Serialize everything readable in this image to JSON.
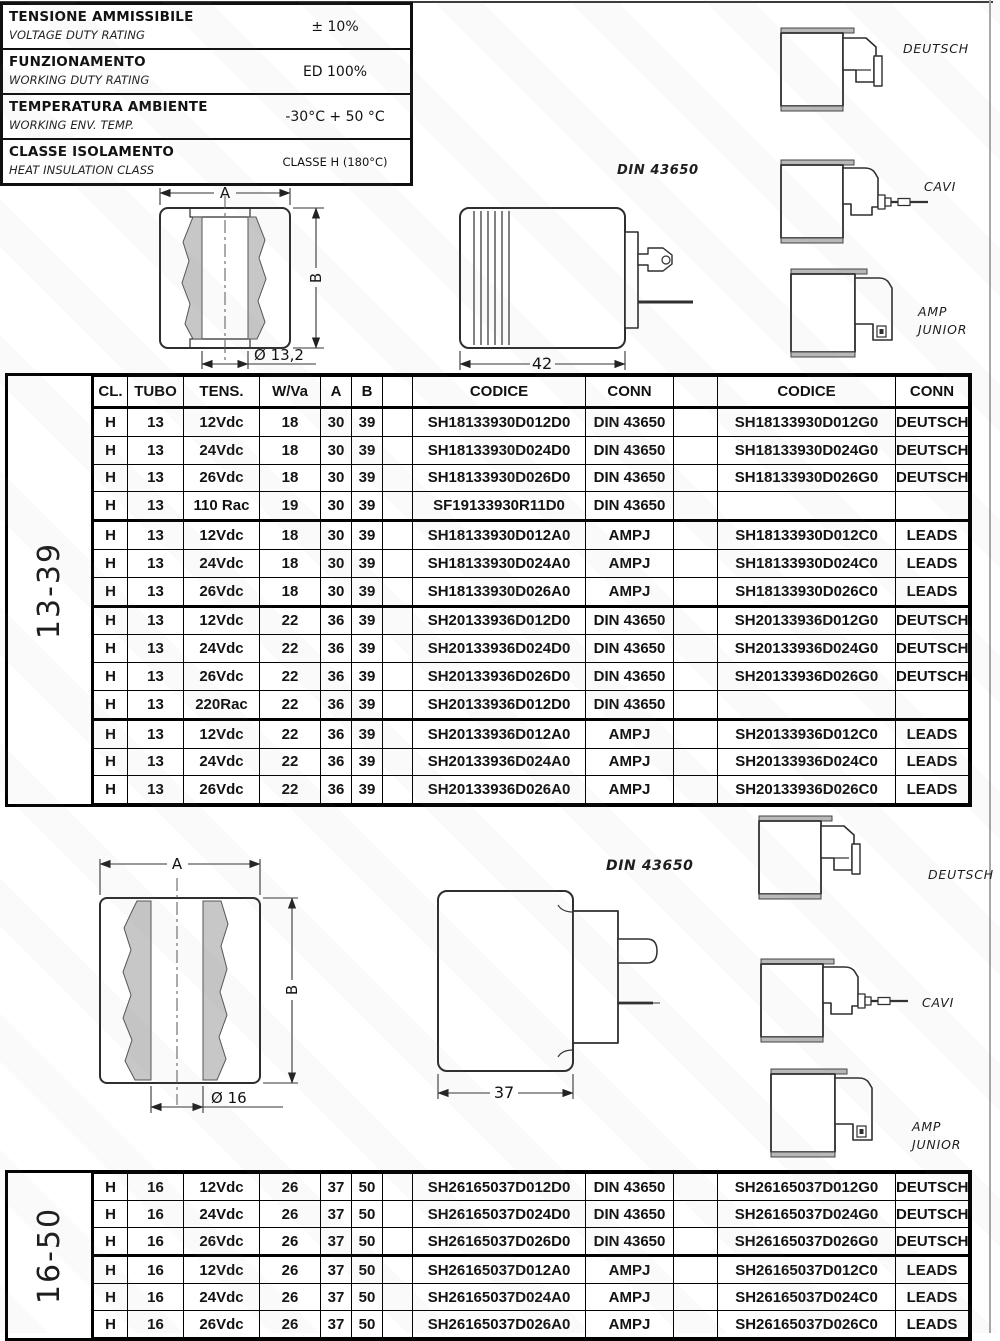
{
  "specs": {
    "rows": [
      {
        "it": "TENSIONE AMMISSIBILE",
        "en": "VOLTAGE DUTY RATING",
        "value": "± 10%"
      },
      {
        "it": "FUNZIONAMENTO",
        "en": "WORKING DUTY RATING",
        "value": "ED 100%"
      },
      {
        "it": "TEMPERATURA AMBIENTE",
        "en": "WORKING ENV. TEMP.",
        "value": "-30°C  + 50 °C"
      },
      {
        "it": "CLASSE ISOLAMENTO",
        "en": "HEAT INSULATION CLASS",
        "value": "CLASSE H (180°C)",
        "cls": "small"
      }
    ]
  },
  "drawings": {
    "s1": {
      "dim_a": "A",
      "dim_b": "B",
      "dim_dia": "Ø 13,2",
      "din_label": "DIN 43650",
      "din_dim": "42",
      "conn_deutsch": "DEUTSCH",
      "conn_cavi": "CAVI",
      "conn_amp": "AMP\nJUNIOR"
    },
    "s2": {
      "dim_a": "A",
      "dim_b": "B",
      "dim_dia": "Ø 16",
      "din_label": "DIN 43650",
      "din_dim": "37",
      "conn_deutsch": "DEUTSCH",
      "conn_cavi": "CAVI",
      "conn_amp": "AMP\nJUNIOR"
    }
  },
  "tables": {
    "t1": {
      "group": "13-39",
      "headers": [
        "CL.",
        "TUBO",
        "TENS.",
        "W/Va",
        "A",
        "B",
        "",
        "CODICE",
        "CONN",
        "",
        "CODICE",
        "CONN"
      ],
      "rows": [
        {
          "cl": "H",
          "tubo": "13",
          "tens": "12Vdc",
          "w": "18",
          "a": "30",
          "b": "39",
          "c1": "SH18133930D012D0",
          "n1": "DIN 43650",
          "c2": "SH18133930D012G0",
          "n2": "DEUTSCH"
        },
        {
          "cl": "H",
          "tubo": "13",
          "tens": "24Vdc",
          "w": "18",
          "a": "30",
          "b": "39",
          "c1": "SH18133930D024D0",
          "n1": "DIN 43650",
          "c2": "SH18133930D024G0",
          "n2": "DEUTSCH"
        },
        {
          "cl": "H",
          "tubo": "13",
          "tens": "26Vdc",
          "w": "18",
          "a": "30",
          "b": "39",
          "c1": "SH18133930D026D0",
          "n1": "DIN 43650",
          "c2": "SH18133930D026G0",
          "n2": "DEUTSCH"
        },
        {
          "cl": "H",
          "tubo": "13",
          "tens": "110 Rac",
          "w": "19",
          "a": "30",
          "b": "39",
          "c1": "SF19133930R11D0",
          "n1": "DIN 43650",
          "c2": "",
          "n2": "",
          "cls": "sep"
        },
        {
          "cl": "H",
          "tubo": "13",
          "tens": "12Vdc",
          "w": "18",
          "a": "30",
          "b": "39",
          "c1": "SH18133930D012A0",
          "n1": "AMPJ",
          "c2": "SH18133930D012C0",
          "n2": "LEADS"
        },
        {
          "cl": "H",
          "tubo": "13",
          "tens": "24Vdc",
          "w": "18",
          "a": "30",
          "b": "39",
          "c1": "SH18133930D024A0",
          "n1": "AMPJ",
          "c2": "SH18133930D024C0",
          "n2": "LEADS"
        },
        {
          "cl": "H",
          "tubo": "13",
          "tens": "26Vdc",
          "w": "18",
          "a": "30",
          "b": "39",
          "c1": "SH18133930D026A0",
          "n1": "AMPJ",
          "c2": "SH18133930D026C0",
          "n2": "LEADS",
          "cls": "sep"
        },
        {
          "cl": "H",
          "tubo": "13",
          "tens": "12Vdc",
          "w": "22",
          "a": "36",
          "b": "39",
          "c1": "SH20133936D012D0",
          "n1": "DIN 43650",
          "c2": "SH20133936D012G0",
          "n2": "DEUTSCH"
        },
        {
          "cl": "H",
          "tubo": "13",
          "tens": "24Vdc",
          "w": "22",
          "a": "36",
          "b": "39",
          "c1": "SH20133936D024D0",
          "n1": "DIN 43650",
          "c2": "SH20133936D024G0",
          "n2": "DEUTSCH"
        },
        {
          "cl": "H",
          "tubo": "13",
          "tens": "26Vdc",
          "w": "22",
          "a": "36",
          "b": "39",
          "c1": "SH20133936D026D0",
          "n1": "DIN 43650",
          "c2": "SH20133936D026G0",
          "n2": "DEUTSCH"
        },
        {
          "cl": "H",
          "tubo": "13",
          "tens": "220Rac",
          "w": "22",
          "a": "36",
          "b": "39",
          "c1": "SH20133936D012D0",
          "n1": "DIN 43650",
          "c2": "",
          "n2": "",
          "cls": "sep"
        },
        {
          "cl": "H",
          "tubo": "13",
          "tens": "12Vdc",
          "w": "22",
          "a": "36",
          "b": "39",
          "c1": "SH20133936D012A0",
          "n1": "AMPJ",
          "c2": "SH20133936D012C0",
          "n2": "LEADS"
        },
        {
          "cl": "H",
          "tubo": "13",
          "tens": "24Vdc",
          "w": "22",
          "a": "36",
          "b": "39",
          "c1": "SH20133936D024A0",
          "n1": "AMPJ",
          "c2": "SH20133936D024C0",
          "n2": "LEADS"
        },
        {
          "cl": "H",
          "tubo": "13",
          "tens": "26Vdc",
          "w": "22",
          "a": "36",
          "b": "39",
          "c1": "SH20133936D026A0",
          "n1": "AMPJ",
          "c2": "SH20133936D026C0",
          "n2": "LEADS"
        }
      ]
    },
    "t2": {
      "group": "16-50",
      "rows": [
        {
          "cl": "H",
          "tubo": "16",
          "tens": "12Vdc",
          "w": "26",
          "a": "37",
          "b": "50",
          "c1": "SH26165037D012D0",
          "n1": "DIN 43650",
          "c2": "SH26165037D012G0",
          "n2": "DEUTSCH"
        },
        {
          "cl": "H",
          "tubo": "16",
          "tens": "24Vdc",
          "w": "26",
          "a": "37",
          "b": "50",
          "c1": "SH26165037D024D0",
          "n1": "DIN 43650",
          "c2": "SH26165037D024G0",
          "n2": "DEUTSCH"
        },
        {
          "cl": "H",
          "tubo": "16",
          "tens": "26Vdc",
          "w": "26",
          "a": "37",
          "b": "50",
          "c1": "SH26165037D026D0",
          "n1": "DIN 43650",
          "c2": "SH26165037D026G0",
          "n2": "DEUTSCH",
          "cls": "sep"
        },
        {
          "cl": "H",
          "tubo": "16",
          "tens": "12Vdc",
          "w": "26",
          "a": "37",
          "b": "50",
          "c1": "SH26165037D012A0",
          "n1": "AMPJ",
          "c2": "SH26165037D012C0",
          "n2": "LEADS"
        },
        {
          "cl": "H",
          "tubo": "16",
          "tens": "24Vdc",
          "w": "26",
          "a": "37",
          "b": "50",
          "c1": "SH26165037D024A0",
          "n1": "AMPJ",
          "c2": "SH26165037D024C0",
          "n2": "LEADS"
        },
        {
          "cl": "H",
          "tubo": "16",
          "tens": "26Vdc",
          "w": "26",
          "a": "37",
          "b": "50",
          "c1": "SH26165037D026A0",
          "n1": "AMPJ",
          "c2": "SH26165037D026C0",
          "n2": "LEADS"
        }
      ]
    }
  }
}
